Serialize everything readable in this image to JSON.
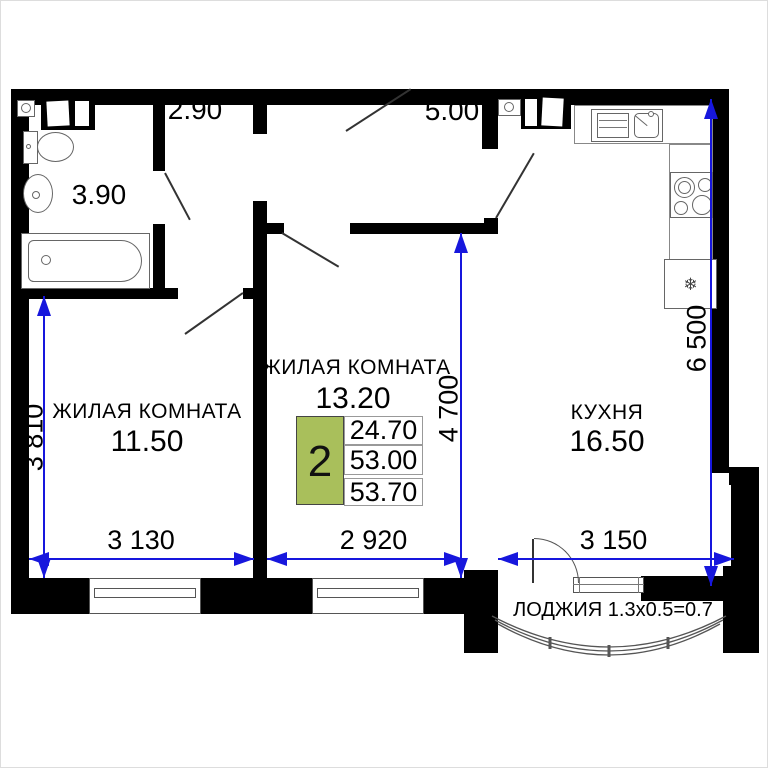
{
  "colors": {
    "wall": "#000000",
    "dimension_blue": "#1717dd",
    "info_green": "#a9bf5b"
  },
  "rooms": {
    "room1": {
      "name": "ЖИЛАЯ КОМНАТА",
      "area": "11.50"
    },
    "room2": {
      "name": "ЖИЛАЯ КОМНАТА",
      "area": "13.20"
    },
    "kitchen": {
      "name": "КУХНЯ",
      "area": "16.50"
    },
    "bathroom": {
      "area": "3.90"
    },
    "hall": {
      "area": "2.90"
    },
    "entry": {
      "area": "5.00"
    },
    "loggia": {
      "label": "ЛОДЖИЯ 1.3x0.5=0.7"
    }
  },
  "dimensions": {
    "room1_width": "3 130",
    "room2_width": "2 920",
    "kitchen_width": "3 150",
    "room1_height": "3 810",
    "room2_height": "4 700",
    "kitchen_height": "6 500"
  },
  "info_table": {
    "rooms_count": "2",
    "living_area": "24.70",
    "floor_area": "53.00",
    "total_area": "53.70"
  },
  "icons": {
    "fridge_snowflake": "❄"
  }
}
